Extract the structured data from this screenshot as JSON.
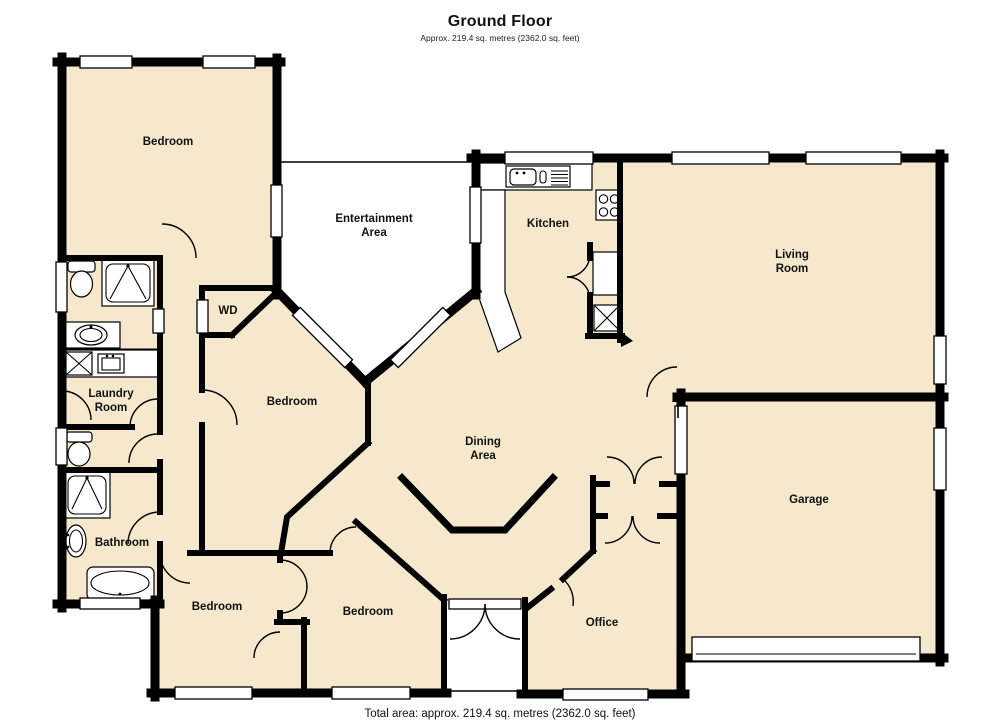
{
  "header": {
    "title": "Ground Floor",
    "subtitle": "Approx. 219.4 sq. metres (2362.0 sq. feet)"
  },
  "footer": {
    "text": "Total area: approx. 219.4 sq. metres (2362.0 sq. feet)"
  },
  "colors": {
    "floor": "#f6e8cc",
    "wall": "#000000",
    "open_area": "#ffffff"
  },
  "rooms": {
    "bedroom_tl": "Bedroom",
    "entertainment_line1": "Entertainment",
    "entertainment_line2": "Area",
    "kitchen": "Kitchen",
    "living_line1": "Living",
    "living_line2": "Room",
    "wd": "WD",
    "laundry_line1": "Laundry",
    "laundry_line2": "Room",
    "bedroom_mid": "Bedroom",
    "dining_line1": "Dining",
    "dining_line2": "Area",
    "bathroom": "Bathroom",
    "garage": "Garage",
    "bedroom_bl": "Bedroom",
    "bedroom_bm": "Bedroom",
    "office": "Office"
  },
  "fixture_icons": [
    "toilet-icon",
    "shower-icon",
    "vanity-sink-icon",
    "washing-machine-icon",
    "laundry-sink-icon",
    "bathtub-icon",
    "kitchen-sink-icon",
    "cooktop-icon",
    "appliance-icon",
    "garage-door",
    "entry-door",
    "window",
    "door-swing-arc"
  ]
}
